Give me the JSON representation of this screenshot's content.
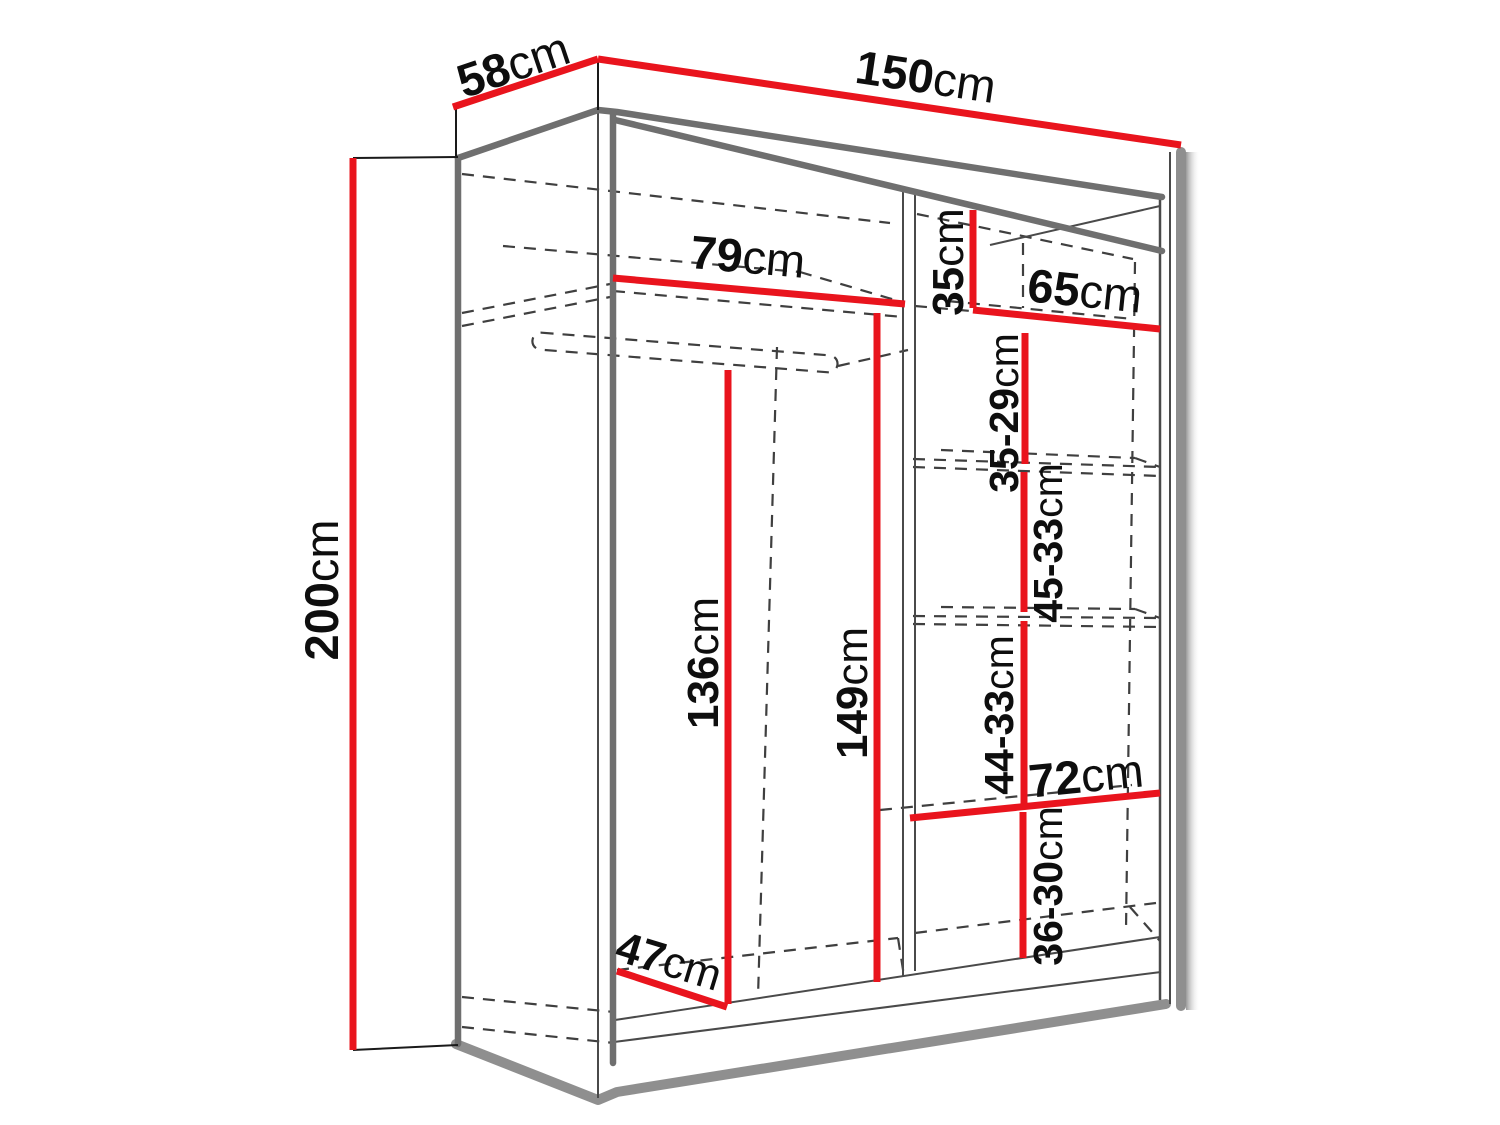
{
  "diagram": {
    "title": "wardrobe-dimensions",
    "unit": "cm",
    "colors": {
      "dimension": "#e9141d",
      "edge": "#6f6f6f",
      "thin": "#4a4a4a",
      "dash": "#3f3f3f",
      "shadow": "#8f8f8f",
      "text": "#0e0e0e",
      "ext": "#1a1a1a",
      "background": "#ffffff"
    },
    "measurements": {
      "top_width": {
        "value": "150",
        "unit": "cm"
      },
      "top_depth": {
        "value": "58",
        "unit": "cm"
      },
      "height": {
        "value": "200",
        "unit": "cm"
      },
      "left_shelf_width": {
        "value": "79",
        "unit": "cm"
      },
      "right_top_section_height": {
        "value": "35",
        "unit": "cm"
      },
      "right_shelf_width": {
        "value": "65",
        "unit": "cm"
      },
      "right_gap_1": {
        "value": "35-29",
        "unit": "cm"
      },
      "right_gap_2": {
        "value": "45-33",
        "unit": "cm"
      },
      "right_gap_3": {
        "value": "44-33",
        "unit": "cm"
      },
      "lower_shelf_width": {
        "value": "72",
        "unit": "cm"
      },
      "right_gap_4": {
        "value": "36-30",
        "unit": "cm"
      },
      "hanging_section_height": {
        "value": "136",
        "unit": "cm"
      },
      "middle_section_height": {
        "value": "149",
        "unit": "cm"
      },
      "interior_depth": {
        "value": "47",
        "unit": "cm"
      }
    }
  }
}
